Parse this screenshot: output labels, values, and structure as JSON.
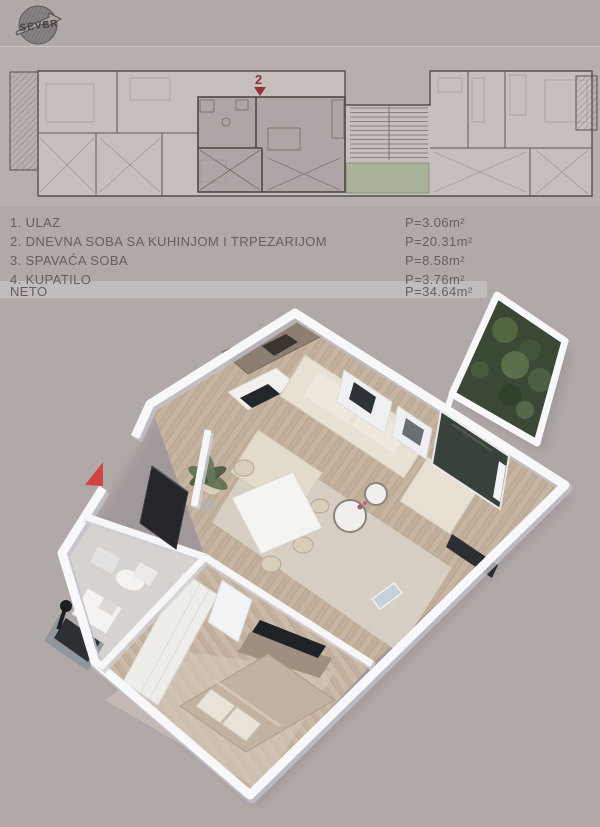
{
  "page": {
    "background": "#b1a8a8",
    "width": 600,
    "height": 827
  },
  "logo": {
    "text": "SEVER"
  },
  "site_plan": {
    "marker_number": "2",
    "marker_color": "#8e3339",
    "highlight_fill": "#9a8f93",
    "stair_court_green": "#a8b399"
  },
  "legend": {
    "rows": [
      {
        "label": "1. ULAZ",
        "area": "P=3.06m²"
      },
      {
        "label": "2. DNEVNA SOBA SA KUHINJOM I TRPEZARIJOM",
        "area": "P=20.31m²"
      },
      {
        "label": "3. SPAVAĆA SOBA",
        "area": "P=8.58m²"
      },
      {
        "label": "4. KUPATILO",
        "area": "P=3.76m²"
      }
    ],
    "total": {
      "label": "NETO",
      "area": "P=34.64m²"
    }
  },
  "render": {
    "entrance_arrow_color": "#cf4444",
    "wall_color": "#f8f7f9",
    "floor_wood": "#c7b5a2",
    "sofa_color": "#e7e0d3",
    "plant_green": "#53663f",
    "glass_dark": "#39423a",
    "entrance_door_color": "#26262a"
  }
}
